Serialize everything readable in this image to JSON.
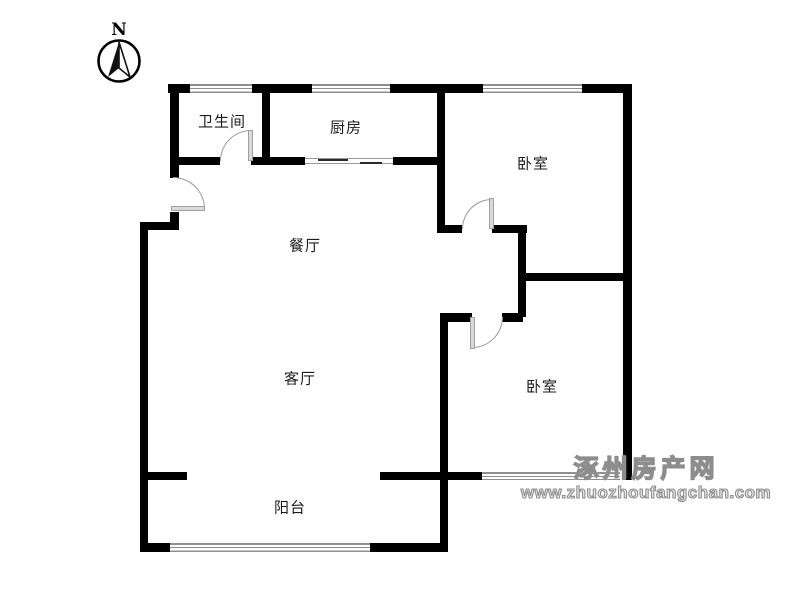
{
  "compass": {
    "north_label": "N"
  },
  "rooms": [
    {
      "name": "bathroom",
      "label": "卫生间",
      "cx": 222,
      "cy": 121
    },
    {
      "name": "kitchen",
      "label": "厨房",
      "cx": 346,
      "cy": 127
    },
    {
      "name": "bedroom-1",
      "label": "卧室",
      "cx": 533,
      "cy": 163
    },
    {
      "name": "dining",
      "label": "餐厅",
      "cx": 305,
      "cy": 245
    },
    {
      "name": "living",
      "label": "客厅",
      "cx": 300,
      "cy": 378
    },
    {
      "name": "bedroom-2",
      "label": "卧室",
      "cx": 542,
      "cy": 386
    },
    {
      "name": "balcony",
      "label": "阳台",
      "cx": 290,
      "cy": 507
    }
  ],
  "watermark": {
    "site_name": "涿州房产网",
    "site_url": "www.zhuozhoufangchan.com"
  },
  "colors": {
    "wall": "#000000",
    "window_line": "#8f8f8f",
    "door_arc": "#9a9a9a",
    "door_leaf": "#d9d9d9",
    "label_text": "#1c1c1c",
    "watermark": "#8d8d8d"
  },
  "plan": {
    "walls": [
      {
        "name": "wall-top-1",
        "x": 168,
        "y": 84,
        "w": 22,
        "h": 9
      },
      {
        "name": "wall-top-2",
        "x": 252,
        "y": 84,
        "w": 60,
        "h": 9
      },
      {
        "name": "wall-top-3",
        "x": 390,
        "y": 84,
        "w": 93,
        "h": 9
      },
      {
        "name": "wall-top-4",
        "x": 582,
        "y": 84,
        "w": 50,
        "h": 9
      },
      {
        "name": "wall-right-outer",
        "x": 623,
        "y": 84,
        "w": 9,
        "h": 396
      },
      {
        "name": "wall-left-upper",
        "x": 170,
        "y": 84,
        "w": 9,
        "h": 94
      },
      {
        "name": "wall-left-entry-stub",
        "x": 170,
        "y": 212,
        "w": 9,
        "h": 18
      },
      {
        "name": "wall-entry-jog",
        "x": 140,
        "y": 222,
        "w": 39,
        "h": 8
      },
      {
        "name": "wall-left-outer",
        "x": 140,
        "y": 222,
        "w": 8,
        "h": 330
      },
      {
        "name": "wall-bath-kitchen",
        "x": 262,
        "y": 84,
        "w": 8,
        "h": 81
      },
      {
        "name": "wall-kitchen-bedroom1",
        "x": 437,
        "y": 84,
        "w": 8,
        "h": 149
      },
      {
        "name": "wall-bath-bottom-1",
        "x": 170,
        "y": 157,
        "w": 50,
        "h": 8
      },
      {
        "name": "wall-bath-bottom-2",
        "x": 251,
        "y": 157,
        "w": 54,
        "h": 8
      },
      {
        "name": "wall-kitchen-bottom",
        "x": 393,
        "y": 157,
        "w": 52,
        "h": 8
      },
      {
        "name": "wall-bedroom1-bottom-1",
        "x": 437,
        "y": 225,
        "w": 25,
        "h": 8
      },
      {
        "name": "wall-bedroom1-bottom-2",
        "x": 492,
        "y": 225,
        "w": 35,
        "h": 8
      },
      {
        "name": "wall-bedrooms-divider",
        "x": 518,
        "y": 273,
        "w": 114,
        "h": 8
      },
      {
        "name": "wall-hall-east",
        "x": 518,
        "y": 225,
        "w": 8,
        "h": 92
      },
      {
        "name": "wall-bedroom2-top-1",
        "x": 440,
        "y": 313,
        "w": 32,
        "h": 9
      },
      {
        "name": "wall-bedroom2-top-2",
        "x": 502,
        "y": 313,
        "w": 21,
        "h": 9
      },
      {
        "name": "wall-living-east",
        "x": 440,
        "y": 313,
        "w": 8,
        "h": 239
      },
      {
        "name": "wall-balcony-stub-left",
        "x": 148,
        "y": 472,
        "w": 39,
        "h": 8
      },
      {
        "name": "wall-balcony-stub-right",
        "x": 380,
        "y": 472,
        "w": 102,
        "h": 8
      },
      {
        "name": "wall-balcony-bottom-1",
        "x": 140,
        "y": 543,
        "w": 30,
        "h": 9
      },
      {
        "name": "wall-balcony-bottom-2",
        "x": 370,
        "y": 543,
        "w": 78,
        "h": 9
      }
    ],
    "windows": [
      {
        "name": "window-bathroom",
        "x": 190,
        "y": 84,
        "w": 62,
        "h": 9
      },
      {
        "name": "window-kitchen",
        "x": 312,
        "y": 84,
        "w": 78,
        "h": 9
      },
      {
        "name": "window-bedroom1",
        "x": 483,
        "y": 84,
        "w": 99,
        "h": 9
      },
      {
        "name": "window-bedroom2",
        "x": 482,
        "y": 472,
        "w": 138,
        "h": 8
      },
      {
        "name": "window-balcony",
        "x": 170,
        "y": 543,
        "w": 200,
        "h": 9
      }
    ],
    "doors": [
      {
        "name": "door-entrance",
        "round": "tr",
        "arc": {
          "x": 173,
          "y": 177,
          "w": 32,
          "h": 32
        },
        "leaf": {
          "x": 171,
          "y": 206,
          "w": 34,
          "h": 5
        }
      },
      {
        "name": "door-bathroom",
        "round": "tl",
        "arc": {
          "x": 220,
          "y": 130,
          "w": 31,
          "h": 31
        },
        "leaf": {
          "x": 248,
          "y": 130,
          "w": 5,
          "h": 31
        }
      },
      {
        "name": "door-bedroom1",
        "round": "tl",
        "arc": {
          "x": 462,
          "y": 199,
          "w": 30,
          "h": 30
        },
        "leaf": {
          "x": 489,
          "y": 198,
          "w": 5,
          "h": 31
        }
      },
      {
        "name": "door-bedroom2",
        "round": "br",
        "arc": {
          "x": 472,
          "y": 317,
          "w": 31,
          "h": 31
        },
        "leaf": {
          "x": 470,
          "y": 317,
          "w": 5,
          "h": 32
        }
      }
    ],
    "sliding_door": {
      "name": "sliding-door-kitchen",
      "x": 305,
      "y": 158,
      "w": 88,
      "h": 6,
      "panels": [
        {
          "x": 13,
          "y": 0,
          "w": 30,
          "h": 2
        },
        {
          "x": 55,
          "y": 3,
          "w": 22,
          "h": 2
        }
      ]
    }
  }
}
